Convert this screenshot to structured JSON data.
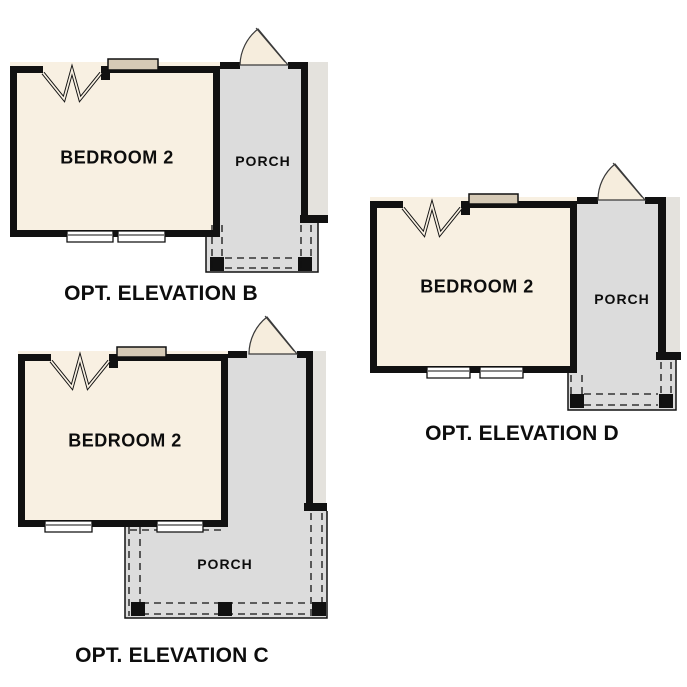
{
  "colors": {
    "wall": "#111111",
    "cream": "#f8f0e2",
    "porch": "#dcdcdc",
    "strip": "#e4e2dd",
    "tan": "#d6cab6",
    "fan": "#f6eddd",
    "page": "#ffffff",
    "text": "#0d0d0d"
  },
  "elevations": {
    "b": {
      "room": "BEDROOM 2",
      "porch": "PORCH",
      "caption": "OPT. ELEVATION B"
    },
    "c": {
      "room": "BEDROOM 2",
      "porch": "PORCH",
      "caption": "OPT. ELEVATION C"
    },
    "d": {
      "room": "BEDROOM 2",
      "porch": "PORCH",
      "caption": "OPT. ELEVATION D"
    }
  }
}
